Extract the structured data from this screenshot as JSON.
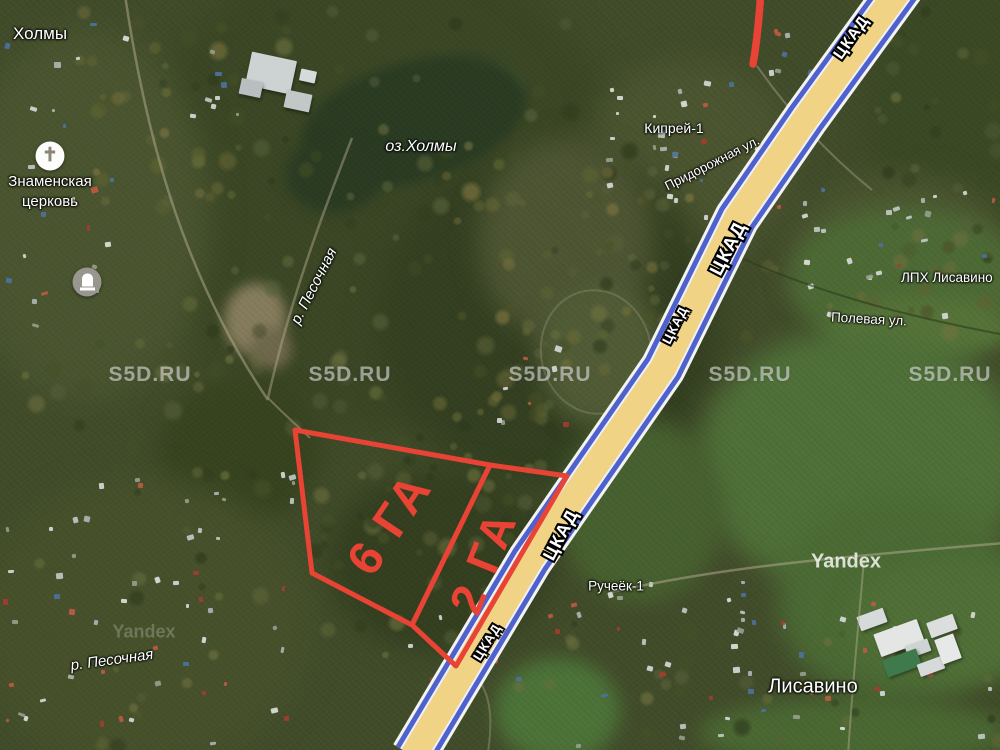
{
  "labels": {
    "settlement_kholmy": "Холмы",
    "church_name_line1": "Знаменская",
    "church_name_line2": "церковь",
    "lake": "оз.Холмы",
    "river_upper": "р. Песочная",
    "river_lower": "р. Песочная",
    "village_kiprey": "Кипрей-1",
    "street_pridorozhnaya": "Придорожная ул.",
    "village_lph_lisavino": "ЛПХ Лисавино",
    "street_polevaya": "Полевая ул.",
    "village_rucheyok": "Ручеёк-1",
    "village_lisavino": "Лисавино",
    "highway": "ЦКАД"
  },
  "parcels": [
    {
      "label": "6 ГА",
      "area_ha": 6
    },
    {
      "label": "2 ГА",
      "area_ha": 2
    }
  ],
  "watermarks": {
    "site": "S5D.RU",
    "provider": "Yandex"
  },
  "colors": {
    "parcel_outline": "#e84335",
    "highway_fill": "#f1d385",
    "highway_border": "#4f61cd",
    "label_text": "#ffffff"
  }
}
